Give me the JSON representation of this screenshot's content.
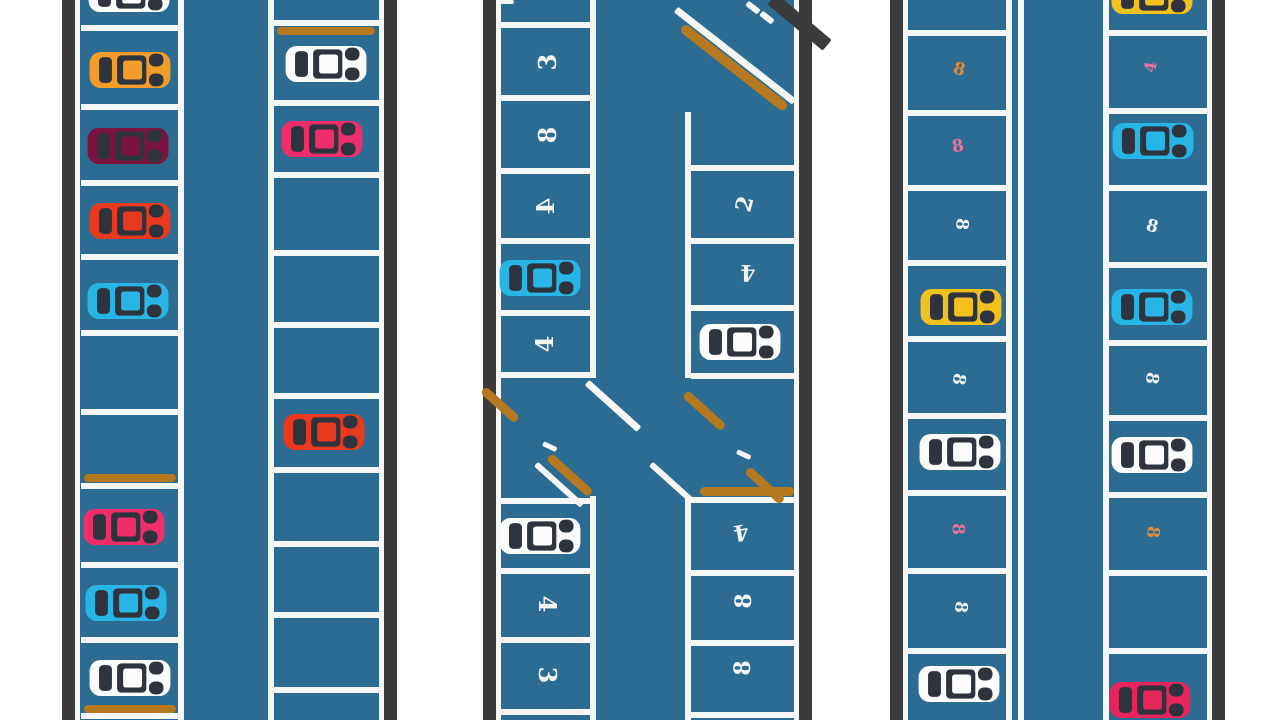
{
  "description": "Top-down illustration of a parking lot with three aisles, parked cars, numbered stalls, curb strips and an intersection",
  "colors": {
    "background": "#ffffff",
    "asphalt": "#2d6c92",
    "border": "#3b3b3d",
    "line": "#f4f7f6",
    "curb": "#b5791f",
    "car_detail": "#2e343d",
    "car_white": "#fcfcfc",
    "car_orange": "#f29d2a",
    "car_maroon": "#7a1340",
    "car_red": "#e8391e",
    "car_cyan": "#29b4e6",
    "car_pink": "#ee2d6b",
    "car_yellow": "#f3c11e",
    "car_crimson": "#e6245c",
    "num_white": "#f2f5f4",
    "num_orange": "#e08a3c",
    "num_pink": "#e873a0"
  },
  "sections": [
    {
      "name": "aisle-left",
      "field": {
        "x": 75,
        "w": 309
      },
      "borders": [
        {
          "x": 62,
          "w": 13
        },
        {
          "x": 384,
          "w": 13
        }
      ],
      "edges": [
        {
          "x": 75,
          "w": 5
        },
        {
          "x": 379,
          "w": 5
        }
      ],
      "lane_lines": [
        {
          "x": 178,
          "w": 6,
          "segs": [
            [
              0,
              720
            ]
          ]
        },
        {
          "x": 268,
          "w": 6,
          "segs": [
            [
              0,
              720
            ]
          ]
        }
      ],
      "strips": [
        {
          "x": 84,
          "y": 474,
          "w": 92,
          "h": 8
        },
        {
          "x": 84,
          "y": 705,
          "w": 92,
          "h": 8
        },
        {
          "x": 277,
          "y": 27,
          "w": 98,
          "h": 8
        }
      ],
      "marks": [],
      "columns": [
        {
          "x": 81,
          "w": 97,
          "dividers": [
            25,
            104,
            180,
            254,
            330,
            409,
            483,
            562,
            637,
            713
          ],
          "stalls": [
            {
              "type": "car",
              "color": "car_white",
              "cx": 129,
              "cy": -6
            },
            {
              "type": "car",
              "color": "car_orange",
              "cx": 130,
              "cy": 70
            },
            {
              "type": "car",
              "color": "car_maroon",
              "cx": 128,
              "cy": 146
            },
            {
              "type": "car",
              "color": "car_red",
              "cx": 130,
              "cy": 221
            },
            {
              "type": "car",
              "color": "car_cyan",
              "cx": 128,
              "cy": 301
            },
            {
              "type": "car",
              "color": "car_pink",
              "cx": 124,
              "cy": 527
            },
            {
              "type": "car",
              "color": "car_cyan",
              "cx": 126,
              "cy": 603
            },
            {
              "type": "car",
              "color": "car_white",
              "cx": 130,
              "cy": 678
            }
          ]
        },
        {
          "x": 274,
          "w": 105,
          "dividers": [
            20,
            100,
            172,
            250,
            322,
            393,
            467,
            541,
            612,
            687
          ],
          "stalls": [
            {
              "type": "car",
              "color": "car_white",
              "cx": 326,
              "cy": 64
            },
            {
              "type": "car",
              "color": "car_pink",
              "cx": 322,
              "cy": 139
            },
            {
              "type": "car",
              "color": "car_red",
              "cx": 324,
              "cy": 432
            }
          ]
        }
      ]
    },
    {
      "name": "aisle-center",
      "field": {
        "x": 496,
        "w": 303
      },
      "borders": [
        {
          "x": 483,
          "w": 13
        },
        {
          "x": 799,
          "w": 13
        }
      ],
      "edges": [
        {
          "x": 496,
          "w": 5
        },
        {
          "x": 794,
          "w": 5
        }
      ],
      "lane_lines": [
        {
          "x": 590,
          "w": 6,
          "segs": [
            [
              0,
              378
            ],
            [
              496,
              720
            ]
          ]
        },
        {
          "x": 685,
          "w": 6,
          "segs": [
            [
              112,
              378
            ],
            [
              496,
              720
            ]
          ]
        }
      ],
      "strips": [],
      "marks": [
        {
          "kind": "white",
          "x": 500,
          "y": 0,
          "w": 14,
          "h": 4,
          "rot": 0
        },
        {
          "kind": "dark",
          "x": 772,
          "y": -8,
          "w": 72,
          "h": 14,
          "rot": 40
        },
        {
          "kind": "white",
          "x": 676,
          "y": 6,
          "w": 150,
          "h": 7,
          "rot": 38
        },
        {
          "kind": "orange",
          "x": 682,
          "y": 22,
          "w": 132,
          "h": 10,
          "rot": 38
        },
        {
          "kind": "white",
          "x": 747,
          "y": 0,
          "w": 15,
          "h": 6,
          "rot": 38
        },
        {
          "kind": "white",
          "x": 761,
          "y": 10,
          "w": 15,
          "h": 6,
          "rot": 38
        },
        {
          "kind": "orange",
          "x": 483,
          "y": 385,
          "w": 46,
          "h": 9,
          "rot": 42
        },
        {
          "kind": "white",
          "x": 587,
          "y": 379,
          "w": 70,
          "h": 7,
          "rot": 42
        },
        {
          "kind": "white",
          "x": 543,
          "y": 441,
          "w": 15,
          "h": 5,
          "rot": 25
        },
        {
          "kind": "orange",
          "x": 549,
          "y": 452,
          "w": 56,
          "h": 9,
          "rot": 42
        },
        {
          "kind": "white",
          "x": 536,
          "y": 461,
          "w": 62,
          "h": 6,
          "rot": 42
        },
        {
          "kind": "orange",
          "x": 685,
          "y": 389,
          "w": 52,
          "h": 9,
          "rot": 42
        },
        {
          "kind": "white",
          "x": 651,
          "y": 461,
          "w": 56,
          "h": 6,
          "rot": 42
        },
        {
          "kind": "white",
          "x": 737,
          "y": 449,
          "w": 15,
          "h": 5,
          "rot": 25
        },
        {
          "kind": "orange",
          "x": 700,
          "y": 487,
          "w": 94,
          "h": 9,
          "rot": 0
        },
        {
          "kind": "orange",
          "x": 747,
          "y": 465,
          "w": 48,
          "h": 9,
          "rot": 42
        }
      ],
      "columns": [
        {
          "x": 501,
          "w": 89,
          "dividers": [
            22,
            95,
            168,
            238,
            310,
            372,
            498,
            568,
            637,
            709
          ],
          "stalls": [
            {
              "type": "number",
              "value": "3",
              "color": "num_white",
              "cx": 548,
              "cy": 62,
              "rot": -90,
              "size": 24
            },
            {
              "type": "number",
              "value": "8",
              "color": "num_white",
              "cx": 548,
              "cy": 135,
              "rot": -90,
              "size": 24
            },
            {
              "type": "number",
              "value": "4",
              "color": "num_white",
              "cx": 546,
              "cy": 206,
              "rot": -90,
              "size": 24,
              "flip": true
            },
            {
              "type": "car",
              "color": "car_cyan",
              "cx": 540,
              "cy": 278
            },
            {
              "type": "number",
              "value": "4",
              "color": "num_white",
              "cx": 545,
              "cy": 344,
              "rot": -90,
              "size": 24
            },
            {
              "type": "car",
              "color": "car_white",
              "cx": 540,
              "cy": 536
            },
            {
              "type": "number",
              "value": "4",
              "color": "num_white",
              "cx": 547,
              "cy": 604,
              "rot": 90,
              "size": 24
            },
            {
              "type": "number",
              "value": "3",
              "color": "num_white",
              "cx": 547,
              "cy": 675,
              "rot": 90,
              "size": 24
            }
          ]
        },
        {
          "x": 691,
          "w": 103,
          "dividers": [
            165,
            238,
            305,
            373,
            497,
            570,
            640,
            712
          ],
          "stalls": [
            {
              "type": "number",
              "value": "2",
              "color": "num_white",
              "cx": 745,
              "cy": 204,
              "rot": -75,
              "size": 22
            },
            {
              "type": "number",
              "value": "4",
              "color": "num_white",
              "cx": 748,
              "cy": 272,
              "rot": 180,
              "size": 22
            },
            {
              "type": "car",
              "color": "car_white",
              "cx": 740,
              "cy": 342
            },
            {
              "type": "number",
              "value": "4",
              "color": "num_white",
              "cx": 741,
              "cy": 532,
              "rot": 170,
              "size": 22
            },
            {
              "type": "number",
              "value": "8",
              "color": "num_white",
              "cx": 744,
              "cy": 601,
              "rot": -90,
              "size": 22
            },
            {
              "type": "number",
              "value": "8",
              "color": "num_white",
              "cx": 743,
              "cy": 668,
              "rot": -90,
              "size": 22
            }
          ]
        }
      ]
    },
    {
      "name": "aisle-right",
      "field": {
        "x": 903,
        "w": 309
      },
      "borders": [
        {
          "x": 890,
          "w": 13
        },
        {
          "x": 1212,
          "w": 13
        }
      ],
      "edges": [
        {
          "x": 903,
          "w": 5
        },
        {
          "x": 1207,
          "w": 5
        }
      ],
      "lane_lines": [
        {
          "x": 1006,
          "w": 6,
          "segs": [
            [
              0,
              720
            ]
          ]
        },
        {
          "x": 1018,
          "w": 6,
          "segs": [
            [
              0,
              720
            ]
          ]
        },
        {
          "x": 1103,
          "w": 6,
          "segs": [
            [
              0,
              720
            ]
          ]
        }
      ],
      "strips": [],
      "marks": [],
      "columns": [
        {
          "x": 908,
          "w": 98,
          "dividers": [
            30,
            110,
            185,
            260,
            336,
            413,
            490,
            568,
            648
          ],
          "stalls": [
            {
              "type": "number",
              "value": "8",
              "color": "num_orange",
              "cx": 959,
              "cy": 70,
              "rot": 15,
              "size": 17
            },
            {
              "type": "number",
              "value": "8",
              "color": "num_pink",
              "cx": 958,
              "cy": 147,
              "rot": -10,
              "size": 17
            },
            {
              "type": "number",
              "value": "8",
              "color": "num_white",
              "cx": 961,
              "cy": 224,
              "rot": 95,
              "size": 17
            },
            {
              "type": "car",
              "color": "car_yellow",
              "cx": 961,
              "cy": 307
            },
            {
              "type": "number",
              "value": "8",
              "color": "num_white",
              "cx": 958,
              "cy": 379,
              "rot": 100,
              "size": 17
            },
            {
              "type": "car",
              "color": "car_white",
              "cx": 960,
              "cy": 452
            },
            {
              "type": "number",
              "value": "8",
              "color": "num_pink",
              "cx": 957,
              "cy": 529,
              "rot": 90,
              "size": 17
            },
            {
              "type": "number",
              "value": "8",
              "color": "num_white",
              "cx": 960,
              "cy": 607,
              "rot": 95,
              "size": 17
            },
            {
              "type": "car",
              "color": "car_white",
              "cx": 959,
              "cy": 684
            }
          ]
        },
        {
          "x": 1109,
          "w": 98,
          "dividers": [
            30,
            108,
            185,
            262,
            340,
            415,
            492,
            570,
            648
          ],
          "stalls": [
            {
              "type": "car",
              "color": "car_yellow",
              "cx": 1152,
              "cy": -4
            },
            {
              "type": "number",
              "value": "4",
              "color": "num_pink",
              "cx": 1151,
              "cy": 67,
              "rot": -80,
              "size": 16
            },
            {
              "type": "car",
              "color": "car_cyan",
              "cx": 1153,
              "cy": 141
            },
            {
              "type": "number",
              "value": "8",
              "color": "num_white",
              "cx": 1152,
              "cy": 227,
              "rot": 15,
              "size": 17
            },
            {
              "type": "car",
              "color": "car_cyan",
              "cx": 1152,
              "cy": 307
            },
            {
              "type": "number",
              "value": "8",
              "color": "num_white",
              "cx": 1151,
              "cy": 378,
              "rot": 100,
              "size": 17
            },
            {
              "type": "car",
              "color": "car_white",
              "cx": 1152,
              "cy": 455
            },
            {
              "type": "number",
              "value": "8",
              "color": "num_orange",
              "cx": 1152,
              "cy": 532,
              "rot": 95,
              "size": 17
            },
            {
              "type": "car",
              "color": "car_crimson",
              "cx": 1150,
              "cy": 700
            }
          ]
        }
      ]
    }
  ]
}
